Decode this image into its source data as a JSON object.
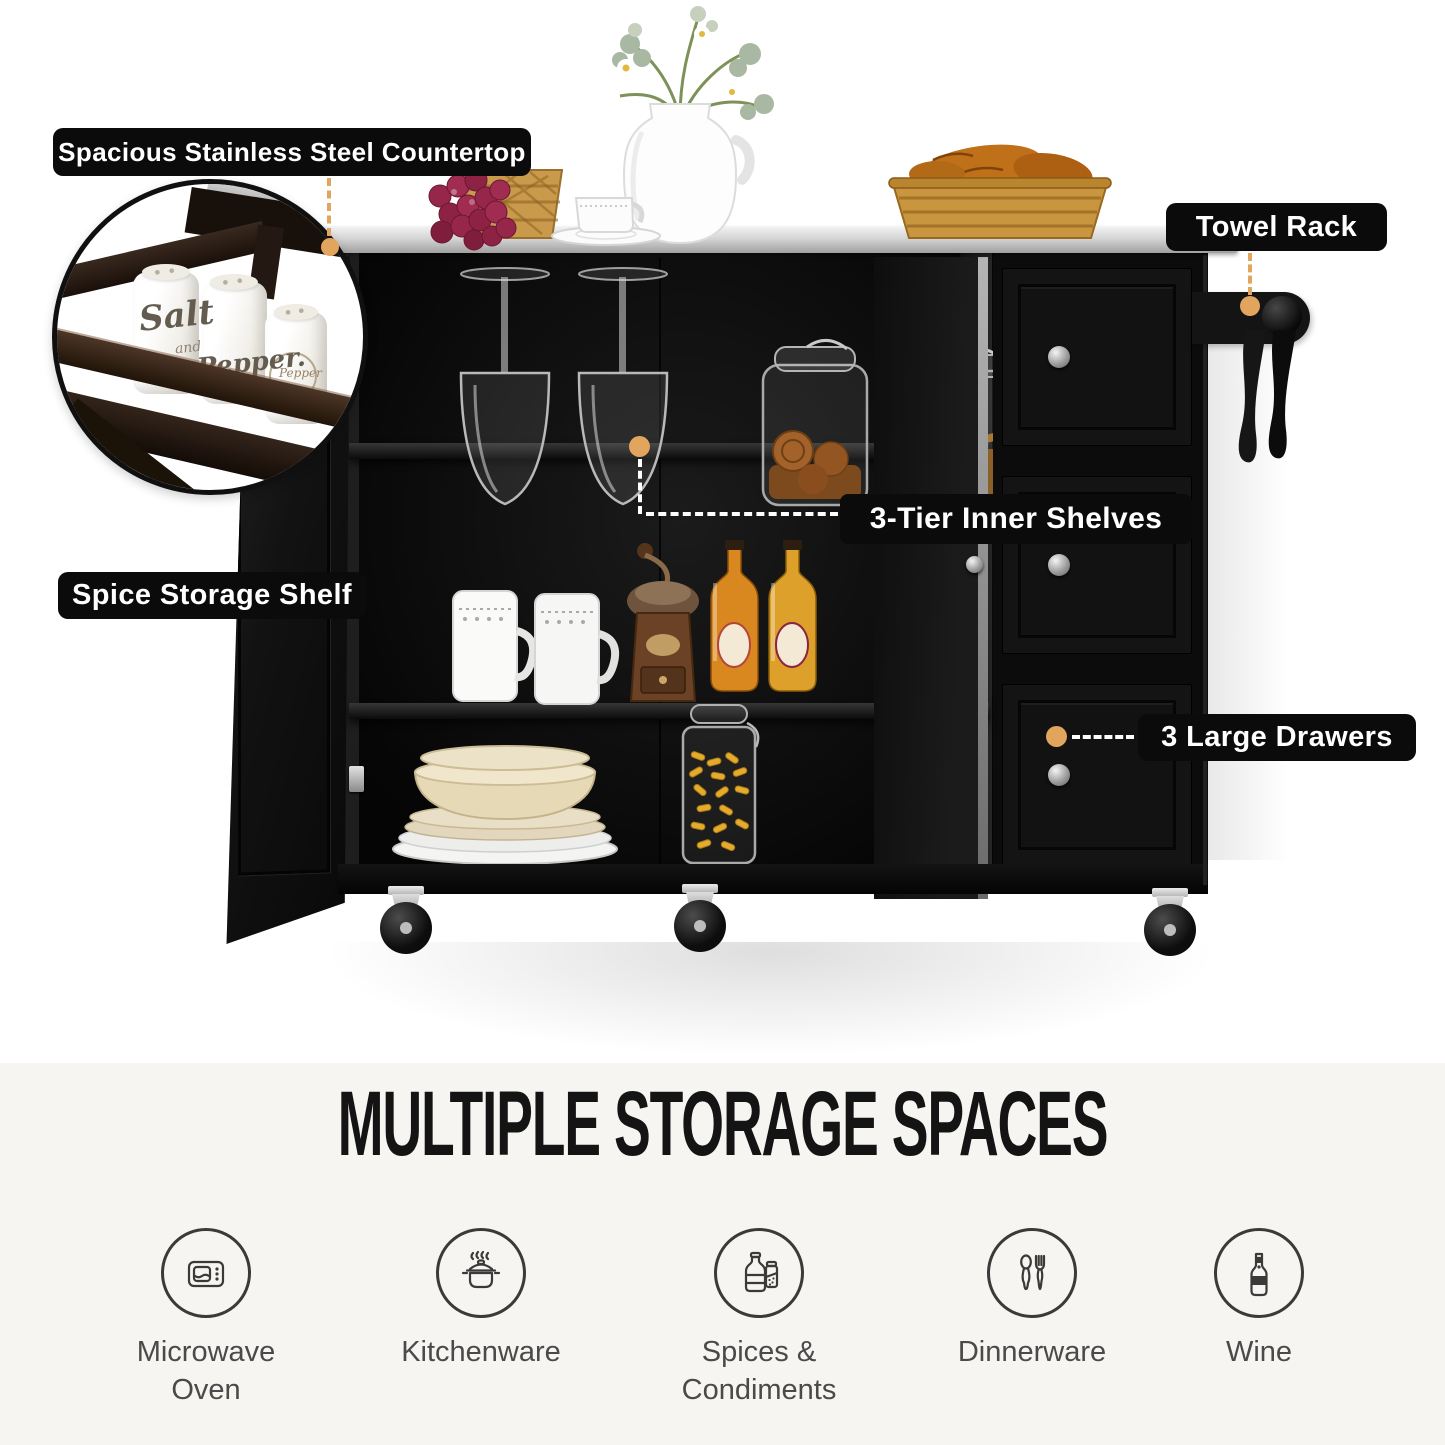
{
  "callouts": {
    "countertop": "Spacious Stainless Steel Countertop",
    "towel_rack": "Towel Rack",
    "inner_shelves": "3-Tier Inner Shelves",
    "spice_shelf": "Spice Storage Shelf",
    "drawers": "3 Large Drawers"
  },
  "inset": {
    "salt": "Salt",
    "and": "and",
    "pepper": "Pepper.",
    "pepper_small": "Pepper"
  },
  "section_title": "MULTIPLE STORAGE SPACES",
  "features": [
    {
      "icon": "microwave-icon",
      "label": "Microwave Oven"
    },
    {
      "icon": "pot-icon",
      "label": "Kitchenware"
    },
    {
      "icon": "spice-bottles-icon",
      "label": "Spices & Condiments"
    },
    {
      "icon": "cutlery-icon",
      "label": "Dinnerware"
    },
    {
      "icon": "wine-bottle-icon",
      "label": "Wine"
    }
  ],
  "colors": {
    "accent_orange": "#E2A55E",
    "label_bg": "#0B0B0B",
    "label_text": "#FFFFFF",
    "bottom_bg": "#F7F5F2",
    "icon_gray": "#3A3A3A",
    "steel": "#C9C9C9",
    "cabinet_black": "#0C0C0C"
  }
}
